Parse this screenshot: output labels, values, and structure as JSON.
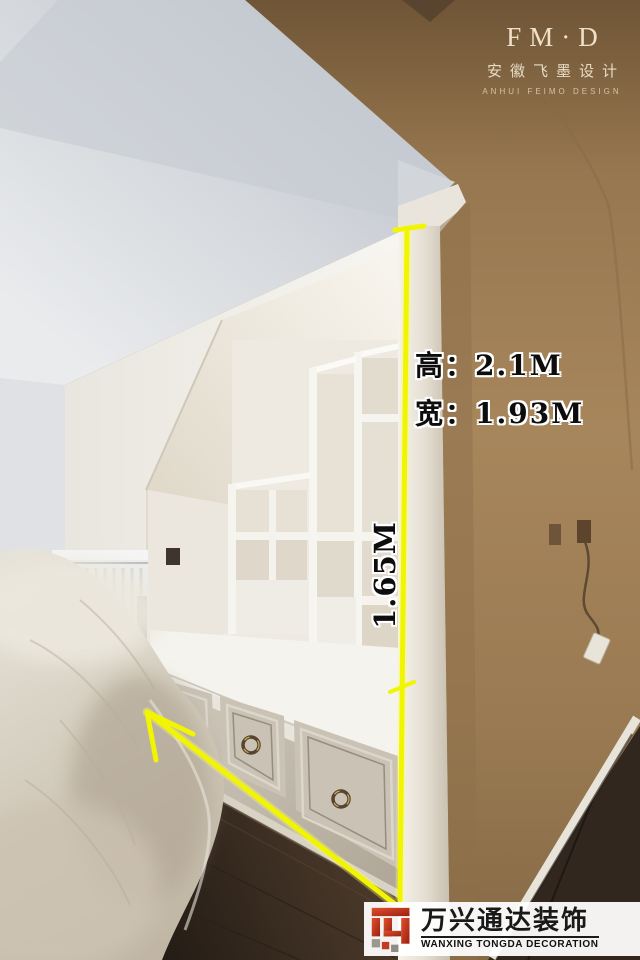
{
  "designer_logo": {
    "name": "FM·D",
    "chinese": "安徽飞墨设计",
    "english": "ANHUI FEIMO DESIGN"
  },
  "annotations": {
    "height": "高：2.1M",
    "width": "宽：1.93M",
    "inner_height": "1.65M",
    "line_color": "#f2f500"
  },
  "watermark": {
    "company": "万兴通达装饰",
    "english": "WANXING TONGDA DECORATION",
    "logo_color": "#c23b22"
  },
  "palette": {
    "accent_yellow": "#f2f500",
    "wall_brown": "#a0805a",
    "floor_brown": "#3b2f25",
    "cabinet_greige": "#c6bfb2",
    "ceiling_gray": "#d4d7db",
    "alcove_white": "#f4f2ec"
  }
}
